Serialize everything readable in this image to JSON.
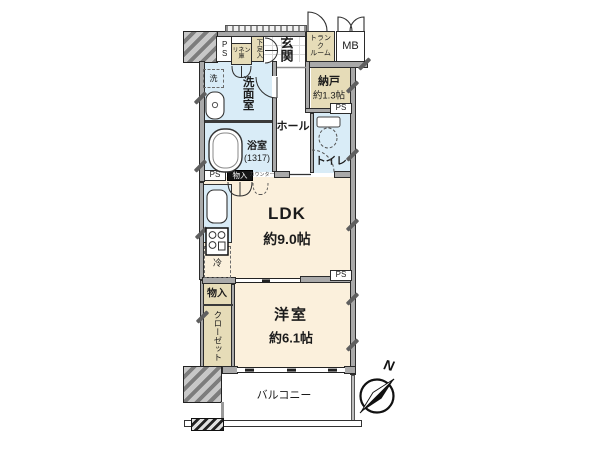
{
  "plan": {
    "rooms": {
      "entrance": "玄関",
      "hall": "ホール",
      "washroom": "洗面室",
      "bathroom": "浴室",
      "bathroom_size": "(1317)",
      "toilet": "トイレ",
      "storage_room": "納戸",
      "storage_room_size": "約1.3帖",
      "ldk": "LDK",
      "ldk_size": "約9.0帖",
      "western_room": "洋室",
      "western_room_size": "約6.1帖",
      "balcony": "バルコニー",
      "closet": "クローゼット",
      "storage_left": "物入",
      "storage_kitchen": "物入",
      "counter": "カウンター",
      "trunk_line1": "トランク",
      "trunk_line2": "ルーム",
      "meter_box": "MB",
      "shoe_cabinet": "下足入",
      "linen_line1": "リネン",
      "linen_line2": "庫"
    },
    "fixtures": {
      "washer": "洗",
      "fridge": "冷"
    },
    "ps": [
      "PS",
      "PS",
      "PS",
      "PS"
    ],
    "compass_north": "N",
    "colors": {
      "room_cream": "#fbf0dc",
      "wet_blue": "#d9ecf7",
      "storage_beige": "#e6dcb8",
      "wall_gray": "#a9a9a9",
      "line_black": "#2b2b2b"
    }
  }
}
